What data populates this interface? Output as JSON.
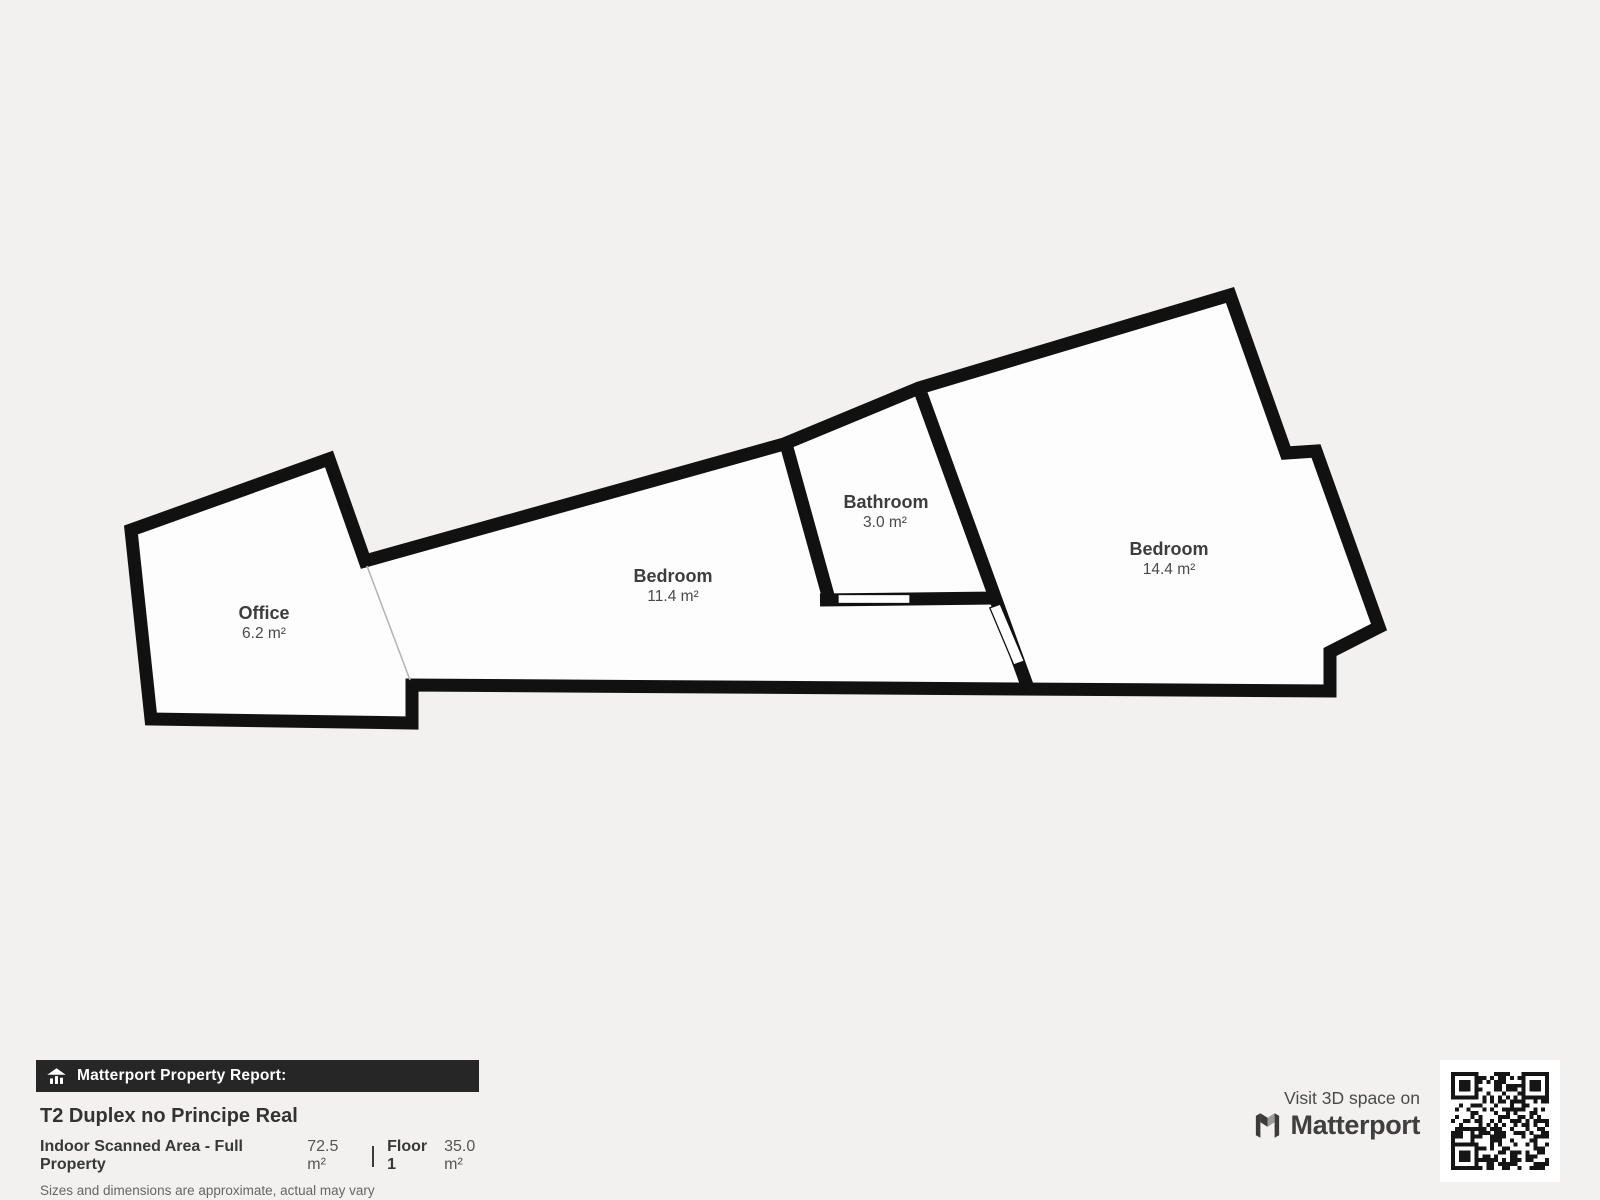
{
  "plan": {
    "rooms": [
      {
        "name": "Office",
        "area": "6.2 m²"
      },
      {
        "name": "Bedroom",
        "area": "11.4 m²"
      },
      {
        "name": "Bathroom",
        "area": "3.0 m²"
      },
      {
        "name": "Bedroom",
        "area": "14.4 m²"
      }
    ]
  },
  "footer": {
    "report_badge": "Matterport Property Report:",
    "property_title": "T2 Duplex no Principe Real",
    "scanned_area_label": "Indoor Scanned Area - Full Property",
    "scanned_area_value": "72.5 m²",
    "floor_label": "Floor 1",
    "floor_value": "35.0 m²",
    "disclaimer": "Sizes and dimensions are approximate, actual may vary"
  },
  "branding": {
    "visit_text": "Visit 3D space on",
    "brand_name": "Matterport",
    "icons": [
      "house-chart-icon",
      "matterport-m-icon",
      "qr-code"
    ]
  },
  "colors": {
    "background": "#f2f1ef",
    "floor": "#fdfdfd",
    "wall": "#111111",
    "label": "#3d3d3d",
    "badge-bg": "#262626",
    "badge-text": "#ffffff",
    "title-text": "#333333",
    "muted-text": "#666666",
    "brand-text": "#3f3f3f",
    "qr": "#151515",
    "opening-line": "#b5b5b5"
  }
}
